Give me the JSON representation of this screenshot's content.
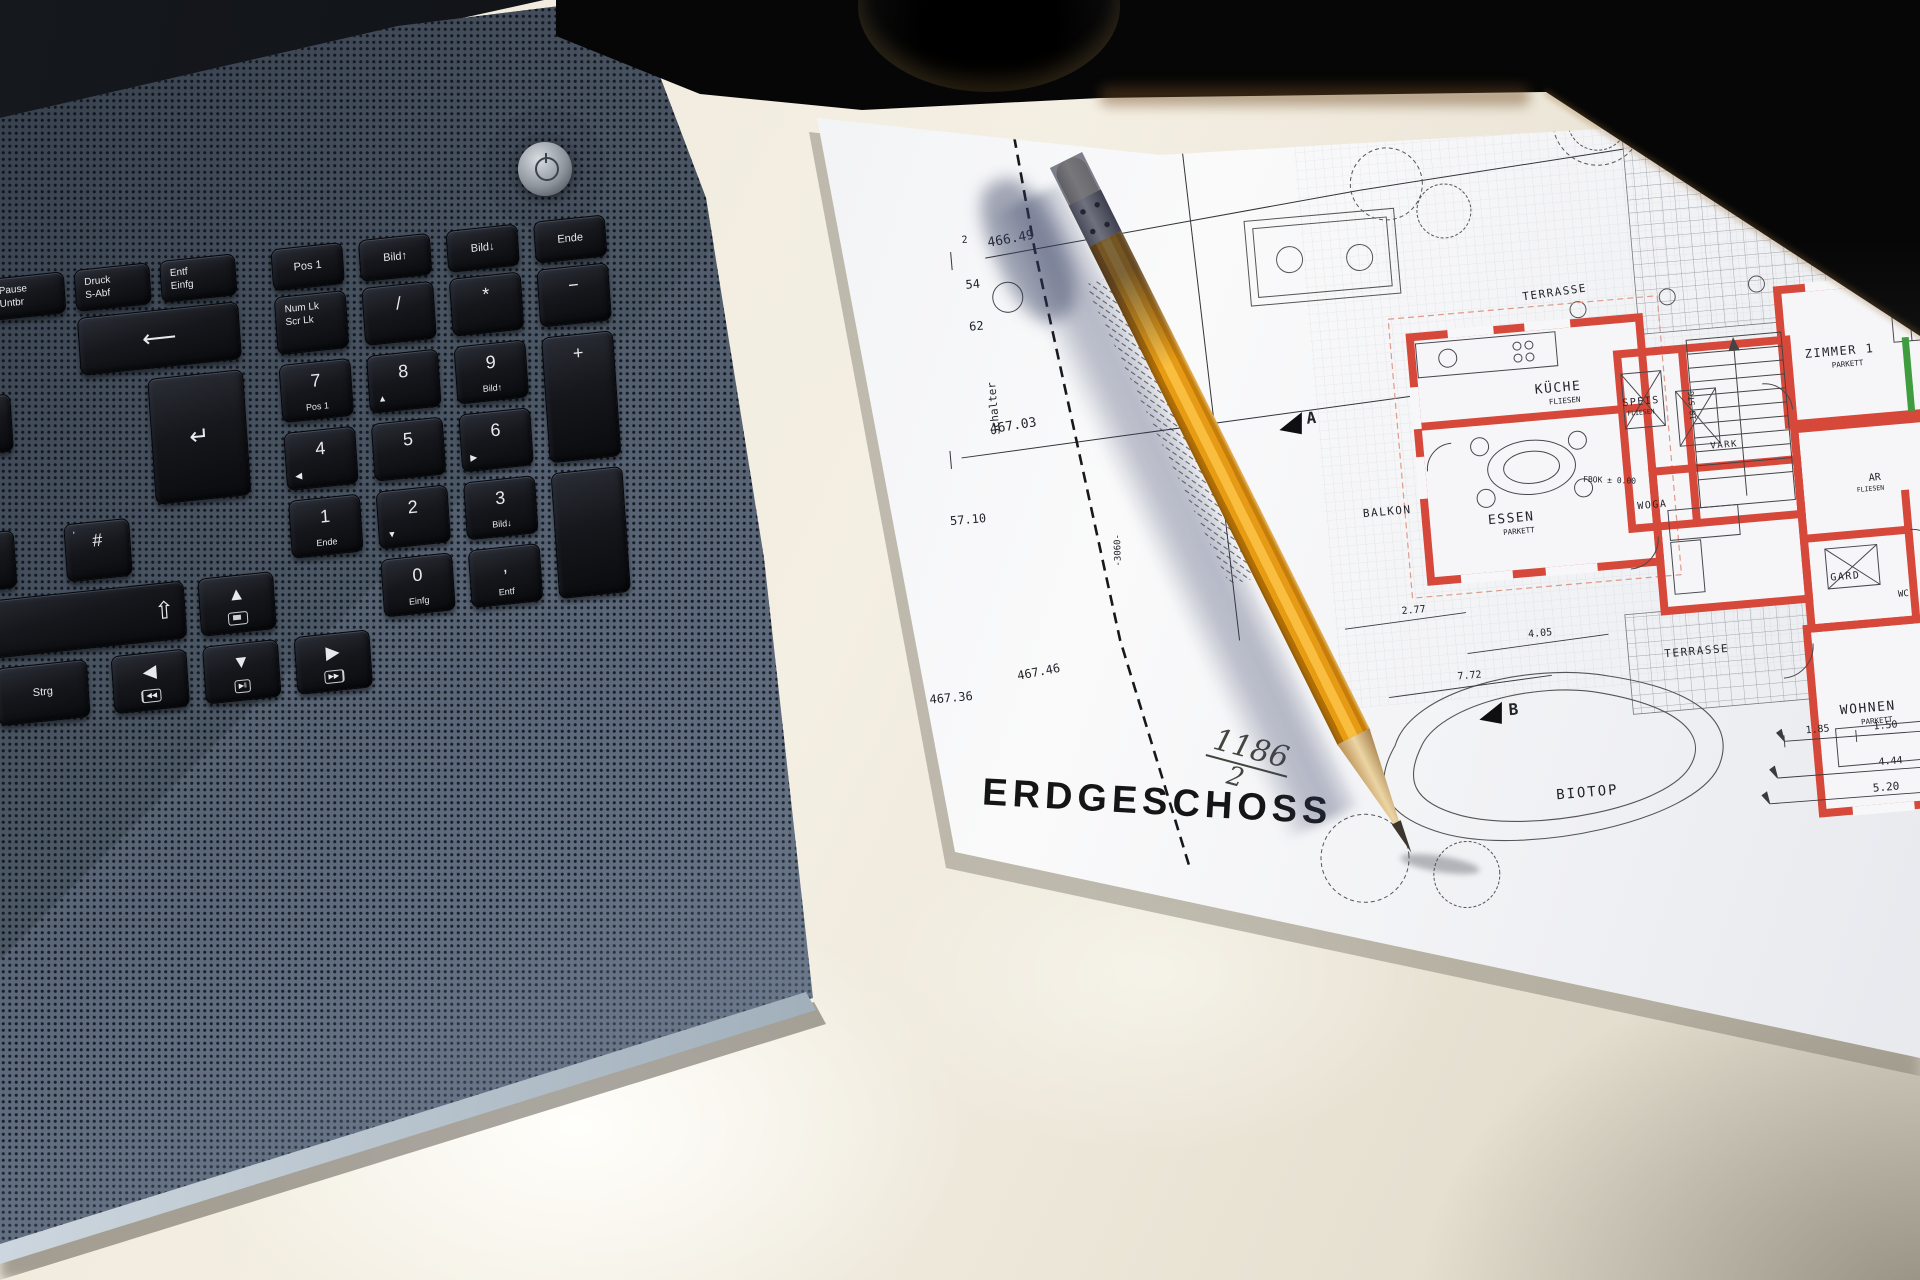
{
  "plan": {
    "title": "ERDGESCHOSS",
    "parcel_number": "1186",
    "parcel_denominator": "2",
    "note_red": "Schalter",
    "survey": {
      "pt2": "2",
      "e466": "466.49",
      "n54": "54",
      "n62": "62",
      "e46703": "467.03",
      "d5710": "57.10",
      "e46736": "467.36",
      "e46746": "467.46",
      "dim3060": "-3060-"
    },
    "rooms": {
      "kueche": "KÜCHE",
      "speis": "SPEIS",
      "vark": "VARK",
      "essen": "ESSEN",
      "balkon": "BALKON",
      "zimmer1": "ZIMMER 1",
      "ar": "AR",
      "gard": "GARD",
      "wc": "WC",
      "wohnen": "WOHNEN",
      "diele": "WOGA",
      "terrasse_top": "TERRASSE",
      "terrasse_unten": "TERRASSE",
      "biotop": "BIOTOP"
    },
    "materials": {
      "parkett": "PARKETT",
      "fliesen": "FLIESEN"
    },
    "stairs": "18 STG",
    "fbok": "FBOK ± 0.00",
    "markers": {
      "a": "A",
      "b": "B"
    },
    "dims": {
      "d277": "2.77",
      "d405": "4.05",
      "d772": "7.72",
      "d185": "1.85",
      "d150": "1.50",
      "d444": "4.44",
      "d520": "5.20"
    },
    "accent_colors": {
      "wall_red": "#d6483a",
      "mark_green": "#3f9d3f",
      "note_pink": "#c27878"
    }
  },
  "keyboard": {
    "media": {
      "prev": "◀◀",
      "play": "▶‖",
      "next": "▶▶"
    },
    "keys": [
      {
        "name": "pause",
        "x": 8,
        "y": 0,
        "w": 74,
        "h": 40,
        "lines": [
          "Pause",
          "Untbr"
        ]
      },
      {
        "name": "druck",
        "x": 94,
        "y": 0,
        "w": 74,
        "h": 40,
        "lines": [
          "Druck",
          "S-Abf"
        ]
      },
      {
        "name": "entf-top",
        "x": 180,
        "y": 0,
        "w": 74,
        "h": 40,
        "lines": [
          "Entf",
          "Einfg"
        ]
      },
      {
        "name": "pos1-top",
        "x": 292,
        "y": 0,
        "w": 70,
        "h": 40,
        "single": "Pos 1"
      },
      {
        "name": "bild-up-top",
        "x": 380,
        "y": 0,
        "w": 70,
        "h": 40,
        "single": "Bild↑"
      },
      {
        "name": "bild-down-top",
        "x": 468,
        "y": 0,
        "w": 70,
        "h": 40,
        "single": "Bild↓"
      },
      {
        "name": "ende-top",
        "x": 556,
        "y": 0,
        "w": 70,
        "h": 40,
        "single": "Ende"
      },
      {
        "name": "acute",
        "x": -54,
        "y": 48,
        "w": 58,
        "h": 56,
        "single": "´"
      },
      {
        "name": "backspace",
        "x": 94,
        "y": 48,
        "w": 160,
        "h": 56,
        "glyph": "⟵"
      },
      {
        "name": "numlock",
        "x": 292,
        "y": 48,
        "w": 70,
        "h": 56,
        "lines": [
          "Num Lk",
          "Scr Lk"
        ]
      },
      {
        "name": "np-divide",
        "x": 380,
        "y": 48,
        "w": 70,
        "h": 56,
        "main": "/"
      },
      {
        "name": "np-multiply",
        "x": 468,
        "y": 48,
        "w": 70,
        "h": 56,
        "main": "*"
      },
      {
        "name": "np-minus",
        "x": 556,
        "y": 48,
        "w": 70,
        "h": 56,
        "main": "−"
      },
      {
        "name": "plus-star-tilde",
        "x": -44,
        "y": 116,
        "w": 64,
        "h": 56,
        "tl": "*",
        "main": "+",
        "corner": "~"
      },
      {
        "name": "enter",
        "x": 160,
        "y": 116,
        "w": 94,
        "h": 124,
        "glyph": "↵"
      },
      {
        "name": "np7",
        "x": 292,
        "y": 116,
        "w": 70,
        "h": 56,
        "main": "7",
        "sub": "Pos 1"
      },
      {
        "name": "np8",
        "x": 380,
        "y": 116,
        "w": 70,
        "h": 56,
        "main": "8",
        "corner": "▲"
      },
      {
        "name": "np9",
        "x": 468,
        "y": 116,
        "w": 70,
        "h": 56,
        "main": "9",
        "sub": "Bild↑"
      },
      {
        "name": "np-plus",
        "x": 556,
        "y": 116,
        "w": 70,
        "h": 124,
        "main": "+"
      },
      {
        "name": "np4",
        "x": 292,
        "y": 184,
        "w": 70,
        "h": 56,
        "main": "4",
        "corner": "◀"
      },
      {
        "name": "np5",
        "x": 380,
        "y": 184,
        "w": 70,
        "h": 56,
        "main": "5"
      },
      {
        "name": "np6",
        "x": 468,
        "y": 184,
        "w": 70,
        "h": 56,
        "main": "6",
        "corner": "▶"
      },
      {
        "name": "ae",
        "x": -50,
        "y": 252,
        "w": 64,
        "h": 56,
        "main": "Ä"
      },
      {
        "name": "hash",
        "x": 66,
        "y": 252,
        "w": 64,
        "h": 56,
        "tl": "'",
        "main": "#"
      },
      {
        "name": "np1",
        "x": 292,
        "y": 252,
        "w": 70,
        "h": 56,
        "main": "1",
        "sub": "Ende"
      },
      {
        "name": "np2",
        "x": 380,
        "y": 252,
        "w": 70,
        "h": 56,
        "main": "2",
        "corner": "▼"
      },
      {
        "name": "np3",
        "x": 468,
        "y": 252,
        "w": 70,
        "h": 56,
        "main": "3",
        "sub": "Bild↓"
      },
      {
        "name": "np-enter",
        "x": 556,
        "y": 252,
        "w": 70,
        "h": 124
      },
      {
        "name": "shift",
        "x": -64,
        "y": 320,
        "w": 244,
        "h": 56,
        "glyph": "⇧",
        "align": "right"
      },
      {
        "name": "arrow-up",
        "x": 196,
        "y": 320,
        "w": 74,
        "h": 56,
        "main": "▲",
        "icon": "display"
      },
      {
        "name": "np0",
        "x": 380,
        "y": 320,
        "w": 70,
        "h": 56,
        "main": "0",
        "sub": "Einfg"
      },
      {
        "name": "np-comma",
        "x": 468,
        "y": 320,
        "w": 70,
        "h": 56,
        "main": ",",
        "sub": "Entf"
      },
      {
        "name": "strg",
        "x": -12,
        "y": 388,
        "w": 90,
        "h": 56,
        "single": "Strg"
      },
      {
        "name": "arrow-left",
        "x": 104,
        "y": 388,
        "w": 74,
        "h": 56,
        "main": "◀",
        "icon": "prev"
      },
      {
        "name": "arrow-down",
        "x": 196,
        "y": 388,
        "w": 74,
        "h": 56,
        "main": "▼",
        "icon": "play"
      },
      {
        "name": "arrow-right",
        "x": 288,
        "y": 388,
        "w": 74,
        "h": 56,
        "main": "▶",
        "icon": "next"
      }
    ]
  },
  "pencil": {
    "body_color": "#f2a71b"
  }
}
